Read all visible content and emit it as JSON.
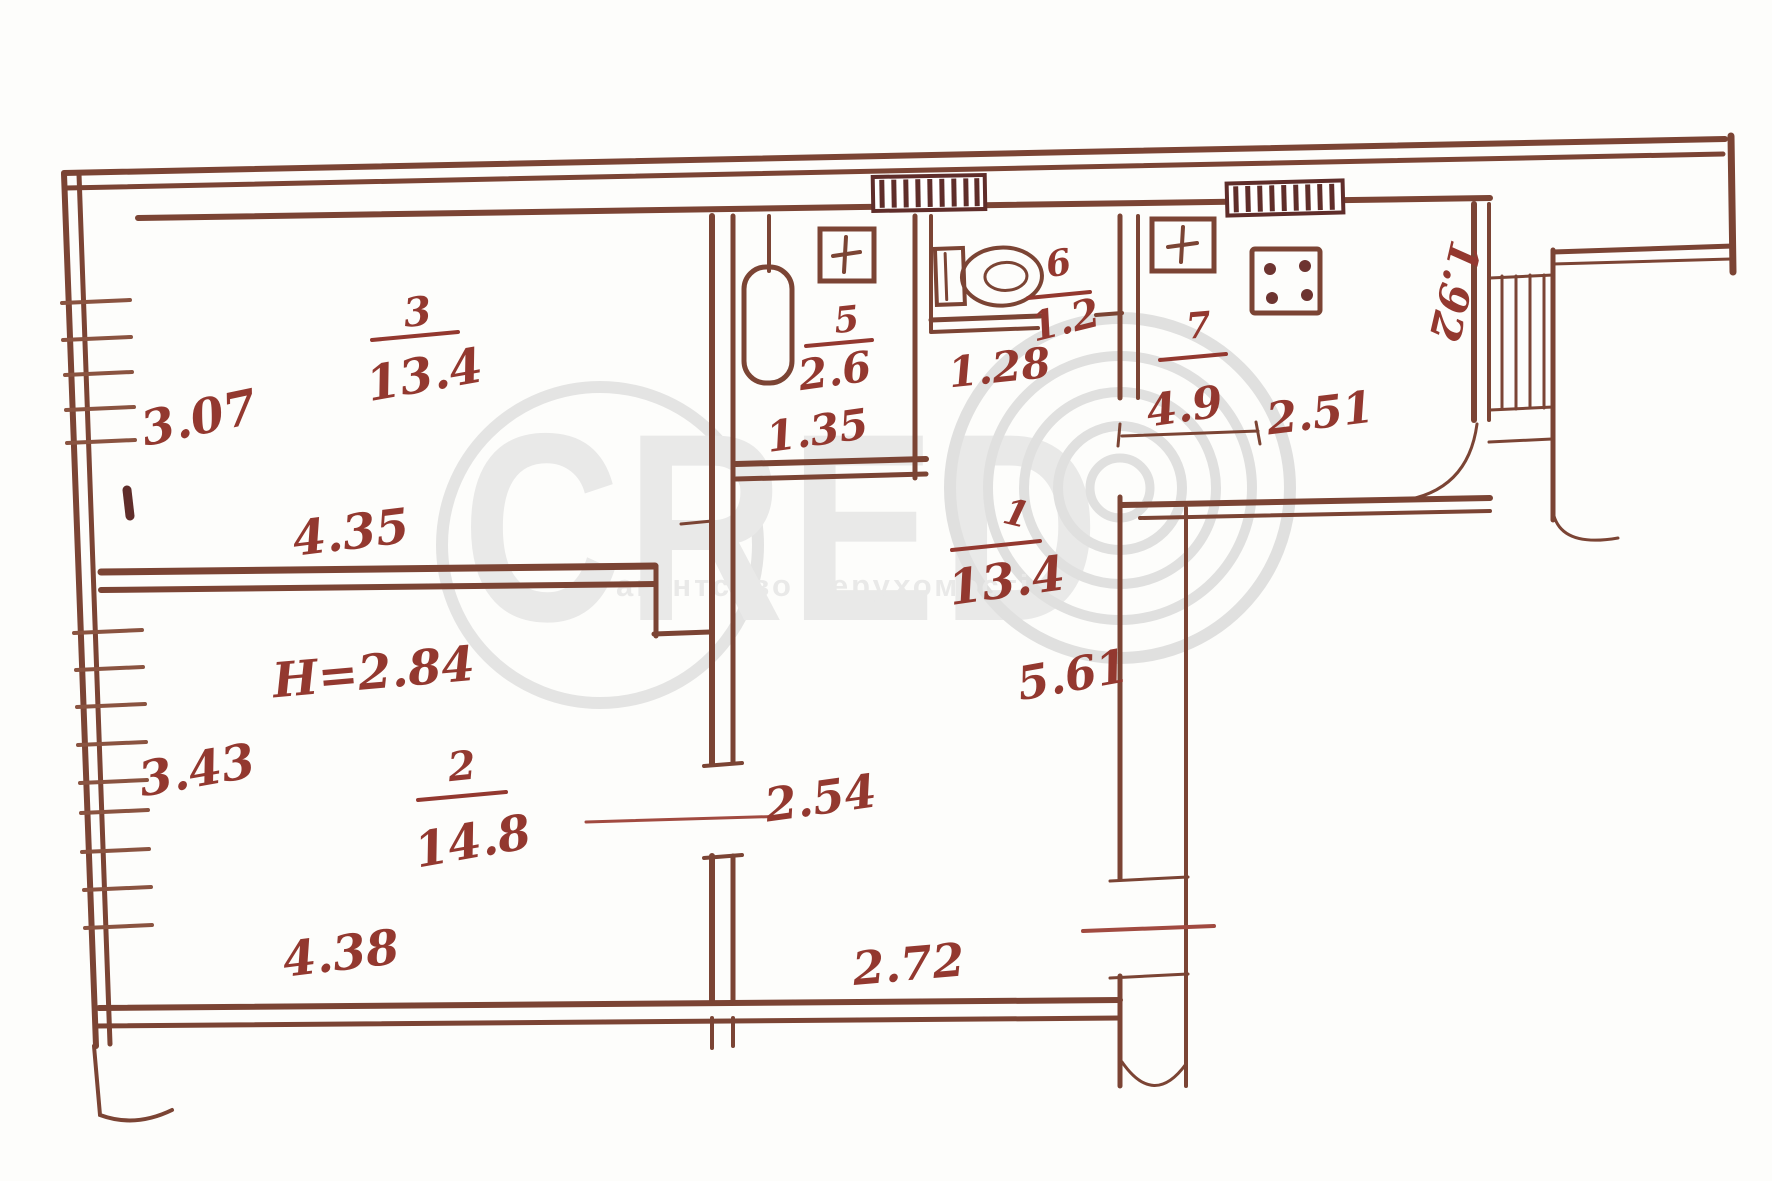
{
  "watermark": {
    "brand": "CRED",
    "agency": "агентство Нерухомості"
  },
  "plan": {
    "ink_color": "#7b4434",
    "text_color": "#93382f",
    "watermark_color": "#d0d0d0",
    "ceiling_height": "Н=2.84",
    "rooms": {
      "living": {
        "number": "3",
        "area": "13.4",
        "depth": "3.07",
        "width": "4.35"
      },
      "bedroom": {
        "number": "2",
        "area": "14.8",
        "depth": "3.43",
        "width": "4.38"
      },
      "hall": {
        "number": "1",
        "area": "13.4",
        "length": "5.61",
        "width_mid": "2.54",
        "width_bottom": "2.72"
      },
      "bathroom": {
        "number": "5",
        "area": "2.6",
        "width": "1.35"
      },
      "wc": {
        "number": "6",
        "area": "1.2",
        "width": "1.28"
      },
      "kitchen": {
        "number": "7",
        "area": "4.9",
        "width": "2.51",
        "depth": "1.92"
      }
    }
  }
}
